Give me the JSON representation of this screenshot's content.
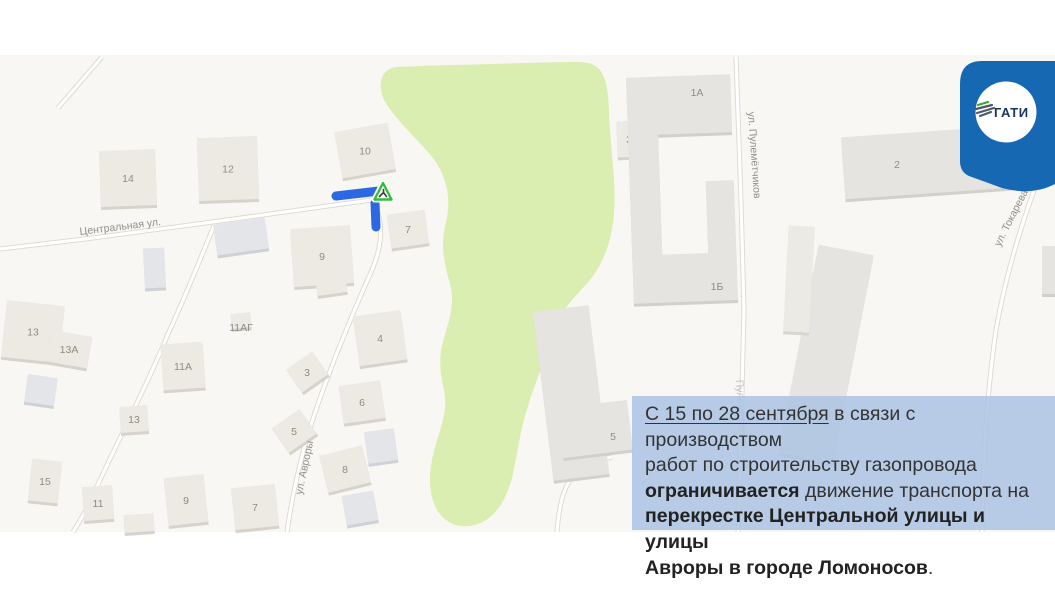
{
  "logo_badge": {
    "text": "ГАТИ",
    "badge_color": "#1668b2",
    "circle_color": "#ffffff",
    "text_color": "#17365d",
    "emblem_green": "#3ea43c",
    "emblem_dark": "#4d5a66"
  },
  "notice": {
    "bg_color": "rgba(173,196,227,0.87)",
    "text_color": "#333333",
    "lines": [
      [
        {
          "t": "С 15 по 28 сентября",
          "u": 1
        },
        {
          "t": " в связи с производством"
        }
      ],
      [
        {
          "t": "работ по строительству газопровода"
        }
      ],
      [
        {
          "t": "ограничивается",
          "b": 1
        },
        {
          "t": " движение транспорта на"
        }
      ],
      [
        {
          "t": "перекрестке Центральной улицы и улицы",
          "b": 1
        }
      ],
      [
        {
          "t": "Авроры в городе Ломоносов",
          "b": 1
        },
        {
          "t": "."
        }
      ]
    ]
  },
  "map": {
    "bg_color": "#f8f7f3",
    "park_color": "#d9eeb0",
    "road_fill": "#ffffff",
    "road_casing": "#dcd8d1",
    "path_dashed_color": "#c9c6c0",
    "closure_color": "#2c67e4",
    "warning_triangle_color": "#2fbf3a",
    "street_label_color": "#8f8f8f",
    "building_label_color": "#8c8c8c",
    "colors": {
      "beige": {
        "f": "#edeae3",
        "s": "#d8d3ca"
      },
      "beige2": {
        "f": "#eceae5",
        "s": "#dad6cd"
      },
      "gray": {
        "f": "#e3e5e8",
        "s": "#ced2d7"
      },
      "lgray": {
        "f": "#e5e4e1",
        "s": "#d2d0cc"
      }
    },
    "street_labels": [
      {
        "t": "Центральная ул.",
        "x": 80,
        "y": 235,
        "r": -7
      },
      {
        "t": "ул. Авроры",
        "x": 302,
        "y": 495,
        "r": -78
      },
      {
        "t": "ул. Пулемётчиков",
        "x": 748,
        "y": 112,
        "r": 86
      },
      {
        "t": "ул. Токарева",
        "x": 1000,
        "y": 247,
        "r": -63
      },
      {
        "t": "Пулеметчиков",
        "x": 736,
        "y": 380,
        "r": 86,
        "o": 0.5
      }
    ],
    "buildings": [
      {
        "l": "14",
        "x": 100,
        "y": 150,
        "w": 56,
        "h": 56,
        "r": -2,
        "c": "beige"
      },
      {
        "l": "12",
        "x": 198,
        "y": 137,
        "w": 60,
        "h": 63,
        "r": -2,
        "c": "beige"
      },
      {
        "l": "10",
        "x": 338,
        "y": 127,
        "w": 54,
        "h": 47,
        "r": -10,
        "c": "beige"
      },
      {
        "l": "7",
        "x": 389,
        "y": 212,
        "w": 38,
        "h": 34,
        "r": -8,
        "c": "beige"
      },
      {
        "l": "9",
        "x": 292,
        "y": 227,
        "w": 60,
        "h": 58,
        "r": -4,
        "c": "beige"
      },
      {
        "l": "",
        "x": 215,
        "y": 221,
        "w": 52,
        "h": 31,
        "r": -8,
        "c": "gray"
      },
      {
        "l": "",
        "x": 144,
        "y": 248,
        "w": 21,
        "h": 40,
        "r": -3,
        "c": "gray"
      },
      {
        "l": "13",
        "x": 4,
        "y": 303,
        "w": 58,
        "h": 57,
        "r": 6,
        "c": "beige"
      },
      {
        "l": "13А",
        "x": 48,
        "y": 333,
        "w": 42,
        "h": 32,
        "r": 10,
        "c": "beige"
      },
      {
        "l": "",
        "x": 26,
        "y": 376,
        "w": 30,
        "h": 28,
        "r": 8,
        "c": "gray"
      },
      {
        "l": "",
        "x": 231,
        "y": 313,
        "w": 20,
        "h": 15,
        "r": -5,
        "c": "beige"
      },
      {
        "l": "11А",
        "x": 162,
        "y": 343,
        "w": 42,
        "h": 46,
        "r": -4,
        "c": "beige"
      },
      {
        "l": "13",
        "x": 120,
        "y": 406,
        "w": 28,
        "h": 26,
        "r": -4,
        "c": "beige"
      },
      {
        "l": "15",
        "x": 30,
        "y": 460,
        "w": 30,
        "h": 42,
        "r": 6,
        "c": "beige"
      },
      {
        "l": "11",
        "x": 83,
        "y": 486,
        "w": 30,
        "h": 34,
        "r": -4,
        "c": "beige"
      },
      {
        "l": "9",
        "x": 166,
        "y": 476,
        "w": 40,
        "h": 48,
        "r": -6,
        "c": "beige"
      },
      {
        "l": "7",
        "x": 233,
        "y": 486,
        "w": 44,
        "h": 42,
        "r": -6,
        "c": "beige"
      },
      {
        "l": "",
        "x": 124,
        "y": 514,
        "w": 30,
        "h": 18,
        "r": -4,
        "c": "beige"
      },
      {
        "l": "5",
        "x": 277,
        "y": 416,
        "w": 34,
        "h": 30,
        "r": -35,
        "c": "beige"
      },
      {
        "l": "3",
        "x": 291,
        "y": 358,
        "w": 32,
        "h": 28,
        "r": -35,
        "c": "beige"
      },
      {
        "l": "6",
        "x": 341,
        "y": 383,
        "w": 42,
        "h": 38,
        "r": -8,
        "c": "beige"
      },
      {
        "l": "4",
        "x": 356,
        "y": 313,
        "w": 48,
        "h": 50,
        "r": -8,
        "c": "beige"
      },
      {
        "l": "8",
        "x": 323,
        "y": 450,
        "w": 44,
        "h": 38,
        "r": -14,
        "c": "beige"
      },
      {
        "l": "",
        "x": 344,
        "y": 493,
        "w": 32,
        "h": 30,
        "r": -10,
        "c": "gray"
      },
      {
        "l": "",
        "x": 366,
        "y": 430,
        "w": 30,
        "h": 32,
        "r": -8,
        "c": "gray"
      },
      {
        "l": "",
        "x": 316,
        "y": 272,
        "w": 30,
        "h": 22,
        "r": -8,
        "c": "beige"
      },
      {
        "l": "",
        "x": 543,
        "y": 308,
        "w": 56,
        "h": 170,
        "r": -7,
        "c": "lgray"
      },
      {
        "l": "",
        "x": 560,
        "y": 404,
        "w": 70,
        "h": 50,
        "r": -7,
        "c": "lgray"
      },
      {
        "l": "",
        "x": 798,
        "y": 248,
        "w": 56,
        "h": 212,
        "r": 11,
        "c": "lgray"
      },
      {
        "l": "",
        "x": 786,
        "y": 226,
        "w": 26,
        "h": 106,
        "r": 3,
        "c": "beige2"
      },
      {
        "l": "3",
        "x": 617,
        "y": 121,
        "w": 24,
        "h": 36,
        "r": -2,
        "c": "beige"
      },
      {
        "l": "",
        "x": 1042,
        "y": 246,
        "w": 14,
        "h": 48,
        "r": 0,
        "c": "lgray"
      },
      {
        "l": "",
        "x": 843,
        "y": 131,
        "w": 182,
        "h": 62,
        "r": -4,
        "c": "lgray"
      }
    ],
    "ring_complex": {
      "color": "lgray",
      "rot": -2,
      "cx": 680,
      "cy": 190,
      "parts": [
        {
          "x": 630,
          "y": 76,
          "w": 104,
          "h": 58
        },
        {
          "x": 630,
          "y": 130,
          "w": 30,
          "h": 172
        },
        {
          "x": 634,
          "y": 254,
          "w": 100,
          "h": 48
        },
        {
          "x": 706,
          "y": 182,
          "w": 28,
          "h": 74
        }
      ]
    },
    "loose_labels": [
      {
        "t": "5",
        "x": 613,
        "y": 440
      },
      {
        "t": "10",
        "x": 827,
        "y": 427,
        "o": 0.45
      },
      {
        "t": "11АГ",
        "x": 241,
        "y": 331
      },
      {
        "t": "1А",
        "x": 697,
        "y": 96
      },
      {
        "t": "1Б",
        "x": 717,
        "y": 290
      },
      {
        "t": "2",
        "x": 897,
        "y": 168
      }
    ],
    "closure_marker": {
      "segments": [
        [
          336,
          196,
          379,
          191
        ],
        [
          375,
          203,
          376,
          227
        ]
      ],
      "triangle_center": [
        383,
        192
      ]
    }
  }
}
